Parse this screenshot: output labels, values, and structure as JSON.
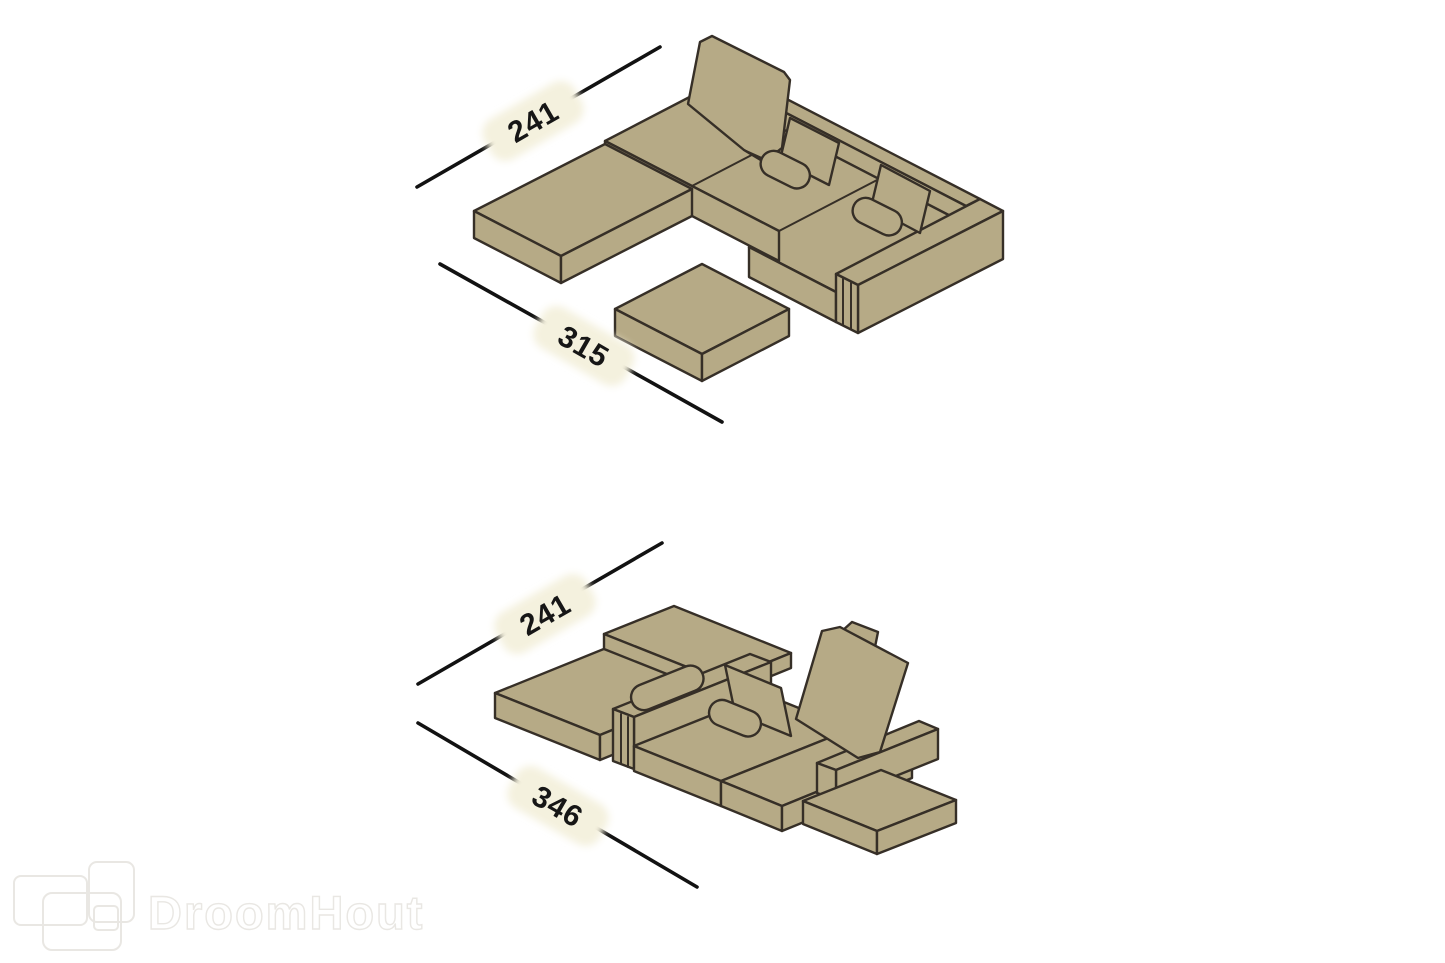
{
  "diagram": {
    "background_color": "#ffffff",
    "sofa_fill_color": "#b6aa86",
    "sofa_outline_color": "#362f27",
    "dimension_line_color": "#121212",
    "dimension_label_bg_color": "#f4f1de",
    "dimension_label_text_color": "#161616",
    "configurations": [
      {
        "name": "sofa-configuration-1",
        "width_cm": "241",
        "length_cm": "315"
      },
      {
        "name": "sofa-configuration-2",
        "width_cm": "241",
        "length_cm": "346"
      }
    ],
    "watermark": {
      "text": "DroomHout",
      "color": "#e9e7e3"
    }
  }
}
